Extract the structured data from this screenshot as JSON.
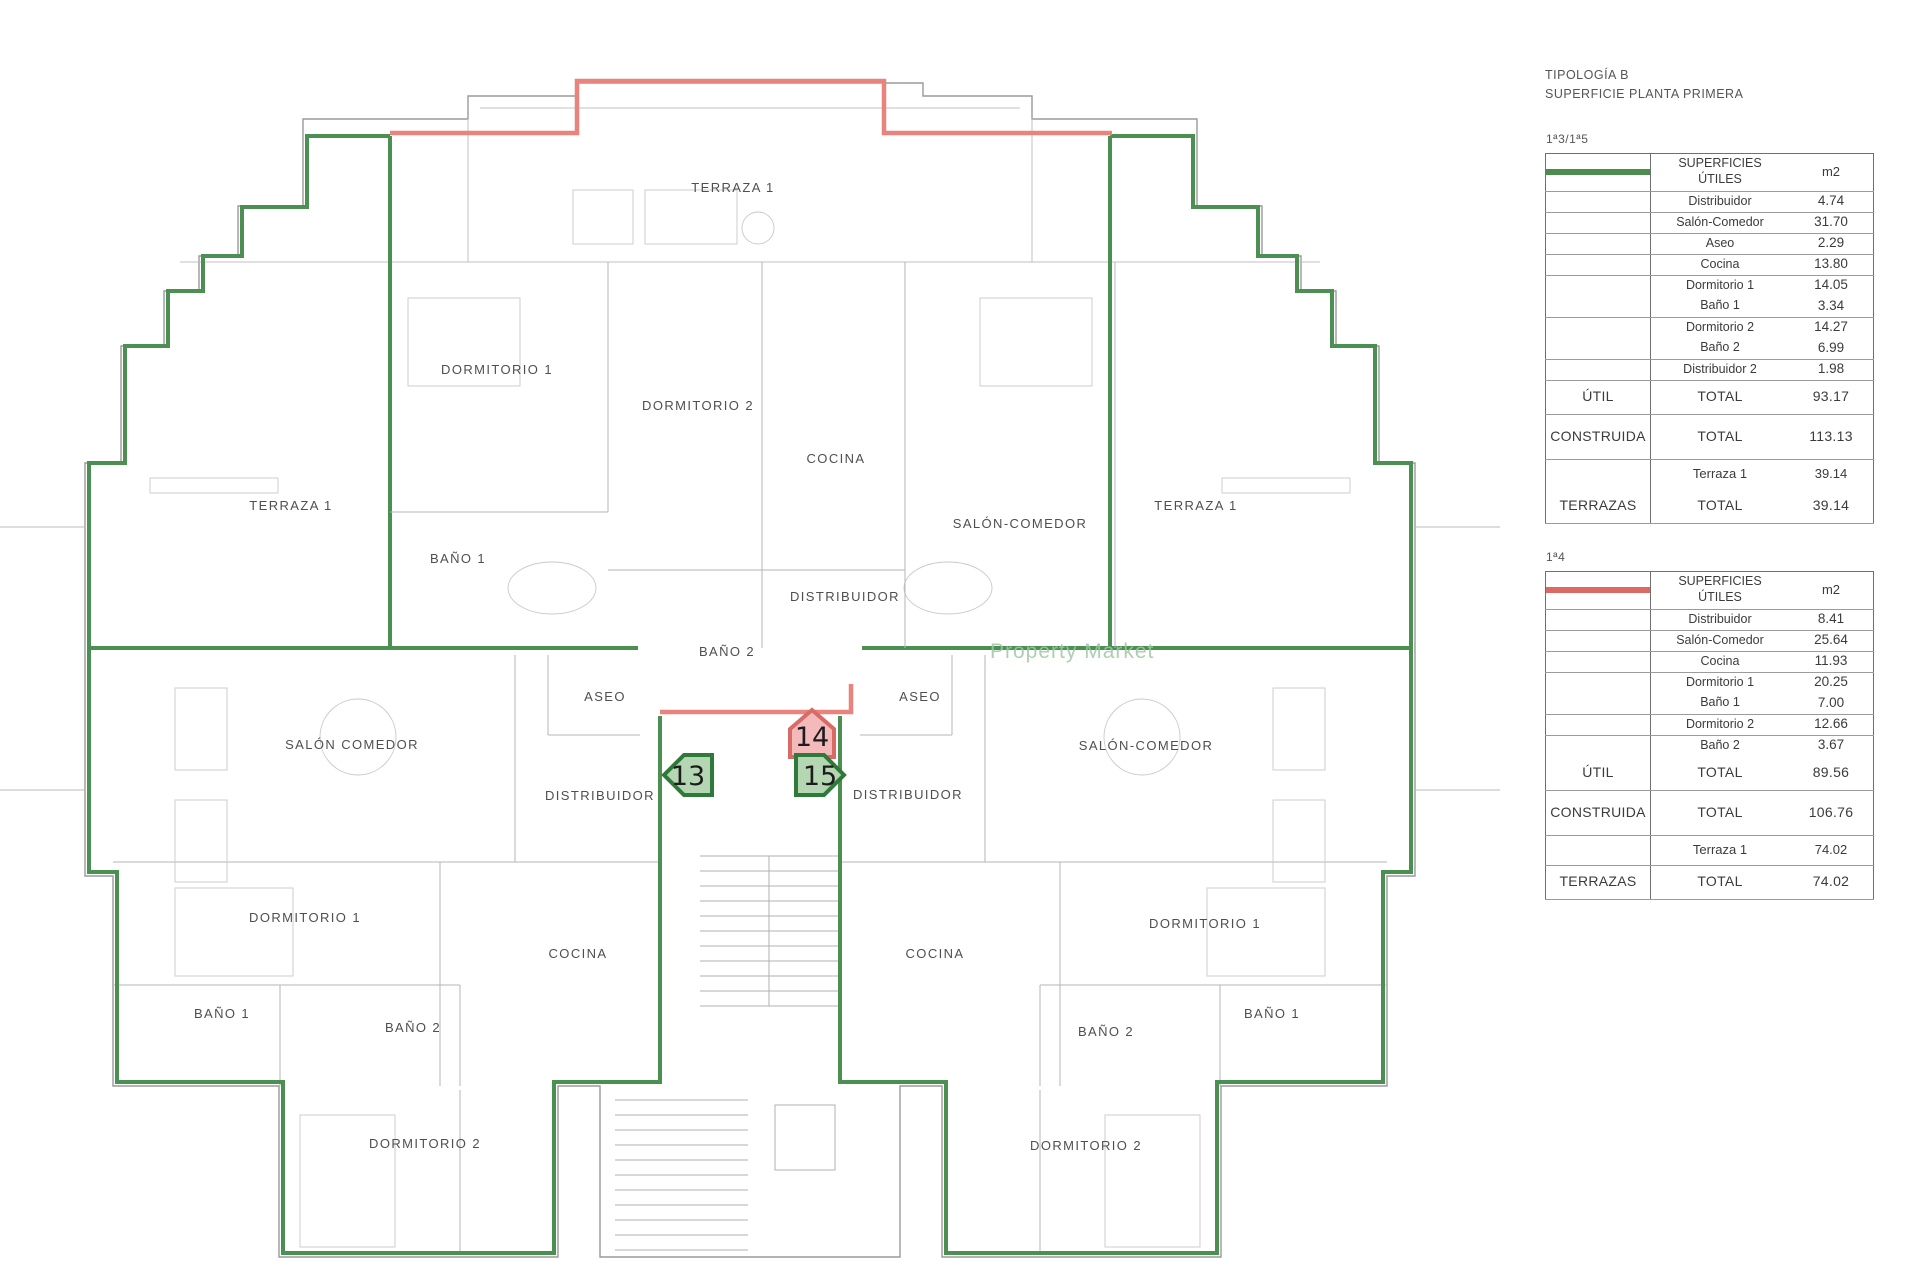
{
  "panel": {
    "title_line1": "TIPOLOGÍA B",
    "title_line2": "SUPERFICIE PLANTA PRIMERA",
    "header_lines": [
      "SUPERFICIES",
      "ÚTILES"
    ],
    "col_m2": "m2",
    "tables": [
      {
        "unit_label": "1ª3/1ª5",
        "swatch_fill": "#a8cfa6",
        "swatch_border": "#4d8b51",
        "rows": [
          {
            "c1": "",
            "c2": "Distribuidor",
            "c3": "4.74",
            "kind": "n"
          },
          {
            "c1": "",
            "c2": "Salón-Comedor",
            "c3": "31.70",
            "kind": "n"
          },
          {
            "c1": "",
            "c2": "Aseo",
            "c3": "2.29",
            "kind": "n"
          },
          {
            "c1": "",
            "c2": "Cocina",
            "c3": "13.80",
            "kind": "n"
          },
          {
            "c1": "",
            "c2": "Dormitorio 1",
            "c3": "14.05",
            "kind": "n",
            "nb": true
          },
          {
            "c1": "",
            "c2": "Baño 1",
            "c3": "3.34",
            "kind": "n"
          },
          {
            "c1": "",
            "c2": "Dormitorio 2",
            "c3": "14.27",
            "kind": "n",
            "nb": true
          },
          {
            "c1": "",
            "c2": "Baño 2",
            "c3": "6.99",
            "kind": "n"
          },
          {
            "c1": "",
            "c2": "Distribuidor 2",
            "c3": "1.98",
            "kind": "n"
          },
          {
            "c1": "ÚTIL",
            "c2": "TOTAL",
            "c3": "93.17",
            "kind": "t"
          },
          {
            "c1": "CONSTRUIDA",
            "c2": "TOTAL",
            "c3": "113.13",
            "kind": "T"
          },
          {
            "c1": "",
            "c2": "Terraza 1",
            "c3": "39.14",
            "kind": "s",
            "nb": true
          },
          {
            "c1": "TERRAZAS",
            "c2": "TOTAL",
            "c3": "39.14",
            "kind": "t"
          }
        ]
      },
      {
        "unit_label": "1ª4",
        "swatch_fill": "#f6bcbd",
        "swatch_border": "#d96a66",
        "rows": [
          {
            "c1": "",
            "c2": "Distribuidor",
            "c3": "8.41",
            "kind": "n"
          },
          {
            "c1": "",
            "c2": "Salón-Comedor",
            "c3": "25.64",
            "kind": "n"
          },
          {
            "c1": "",
            "c2": "Cocina",
            "c3": "11.93",
            "kind": "n"
          },
          {
            "c1": "",
            "c2": "Dormitorio 1",
            "c3": "20.25",
            "kind": "n",
            "nb": true
          },
          {
            "c1": "",
            "c2": "Baño 1",
            "c3": "7.00",
            "kind": "n"
          },
          {
            "c1": "",
            "c2": "Dormitorio 2",
            "c3": "12.66",
            "kind": "n"
          },
          {
            "c1": "",
            "c2": "Baño 2",
            "c3": "3.67",
            "kind": "n",
            "nb": true
          },
          {
            "c1": "ÚTIL",
            "c2": "TOTAL",
            "c3": "89.56",
            "kind": "t"
          },
          {
            "c1": "CONSTRUIDA",
            "c2": "TOTAL",
            "c3": "106.76",
            "kind": "T"
          },
          {
            "c1": "",
            "c2": "Terraza 1",
            "c3": "74.02",
            "kind": "s"
          },
          {
            "c1": "TERRAZAS",
            "c2": "TOTAL",
            "c3": "74.02",
            "kind": "t"
          }
        ]
      }
    ]
  },
  "plan": {
    "watermark": "Property Market",
    "colors": {
      "boundary_green": "#4c8f53",
      "boundary_red": "#e8847d",
      "badge_green_fill": "#b5d6b2",
      "badge_green_border": "#2f7a3a",
      "badge_red_fill": "#f4babb",
      "badge_red_border": "#d96b66",
      "wall_gray": "#9a9a9a"
    },
    "labels": [
      {
        "text": "TERRAZA 1",
        "x": 733,
        "y": 192
      },
      {
        "text": "DORMITORIO 1",
        "x": 497,
        "y": 374
      },
      {
        "text": "DORMITORIO 2",
        "x": 698,
        "y": 410
      },
      {
        "text": "COCINA",
        "x": 836,
        "y": 463
      },
      {
        "text": "SALÓN-COMEDOR",
        "x": 1020,
        "y": 528
      },
      {
        "text": "TERRAZA 1",
        "x": 291,
        "y": 510
      },
      {
        "text": "TERRAZA 1",
        "x": 1196,
        "y": 510
      },
      {
        "text": "BAÑO 1",
        "x": 458,
        "y": 563
      },
      {
        "text": "DISTRIBUIDOR",
        "x": 845,
        "y": 601
      },
      {
        "text": "BAÑO 2",
        "x": 727,
        "y": 656
      },
      {
        "text": "ASEO",
        "x": 605,
        "y": 701
      },
      {
        "text": "ASEO",
        "x": 920,
        "y": 701
      },
      {
        "text": "SALÓN COMEDOR",
        "x": 352,
        "y": 749
      },
      {
        "text": "SALÓN-COMEDOR",
        "x": 1146,
        "y": 750
      },
      {
        "text": "DISTRIBUIDOR",
        "x": 600,
        "y": 800
      },
      {
        "text": "DISTRIBUIDOR",
        "x": 908,
        "y": 799
      },
      {
        "text": "DORMITORIO 1",
        "x": 305,
        "y": 922
      },
      {
        "text": "DORMITORIO 1",
        "x": 1205,
        "y": 928
      },
      {
        "text": "COCINA",
        "x": 578,
        "y": 958
      },
      {
        "text": "COCINA",
        "x": 935,
        "y": 958
      },
      {
        "text": "BAÑO 1",
        "x": 222,
        "y": 1018
      },
      {
        "text": "BAÑO 1",
        "x": 1272,
        "y": 1018
      },
      {
        "text": "BAÑO 2",
        "x": 413,
        "y": 1032
      },
      {
        "text": "BAÑO 2",
        "x": 1106,
        "y": 1036
      },
      {
        "text": "DORMITORIO 2",
        "x": 425,
        "y": 1148
      },
      {
        "text": "DORMITORIO 2",
        "x": 1086,
        "y": 1150
      }
    ],
    "badges": [
      {
        "number": "13",
        "x": 688,
        "y": 775,
        "shape": "arrow-left",
        "theme": "green"
      },
      {
        "number": "14",
        "x": 812,
        "y": 736,
        "shape": "house-up",
        "theme": "red"
      },
      {
        "number": "15",
        "x": 820,
        "y": 775,
        "shape": "arrow-right",
        "theme": "green"
      }
    ]
  }
}
